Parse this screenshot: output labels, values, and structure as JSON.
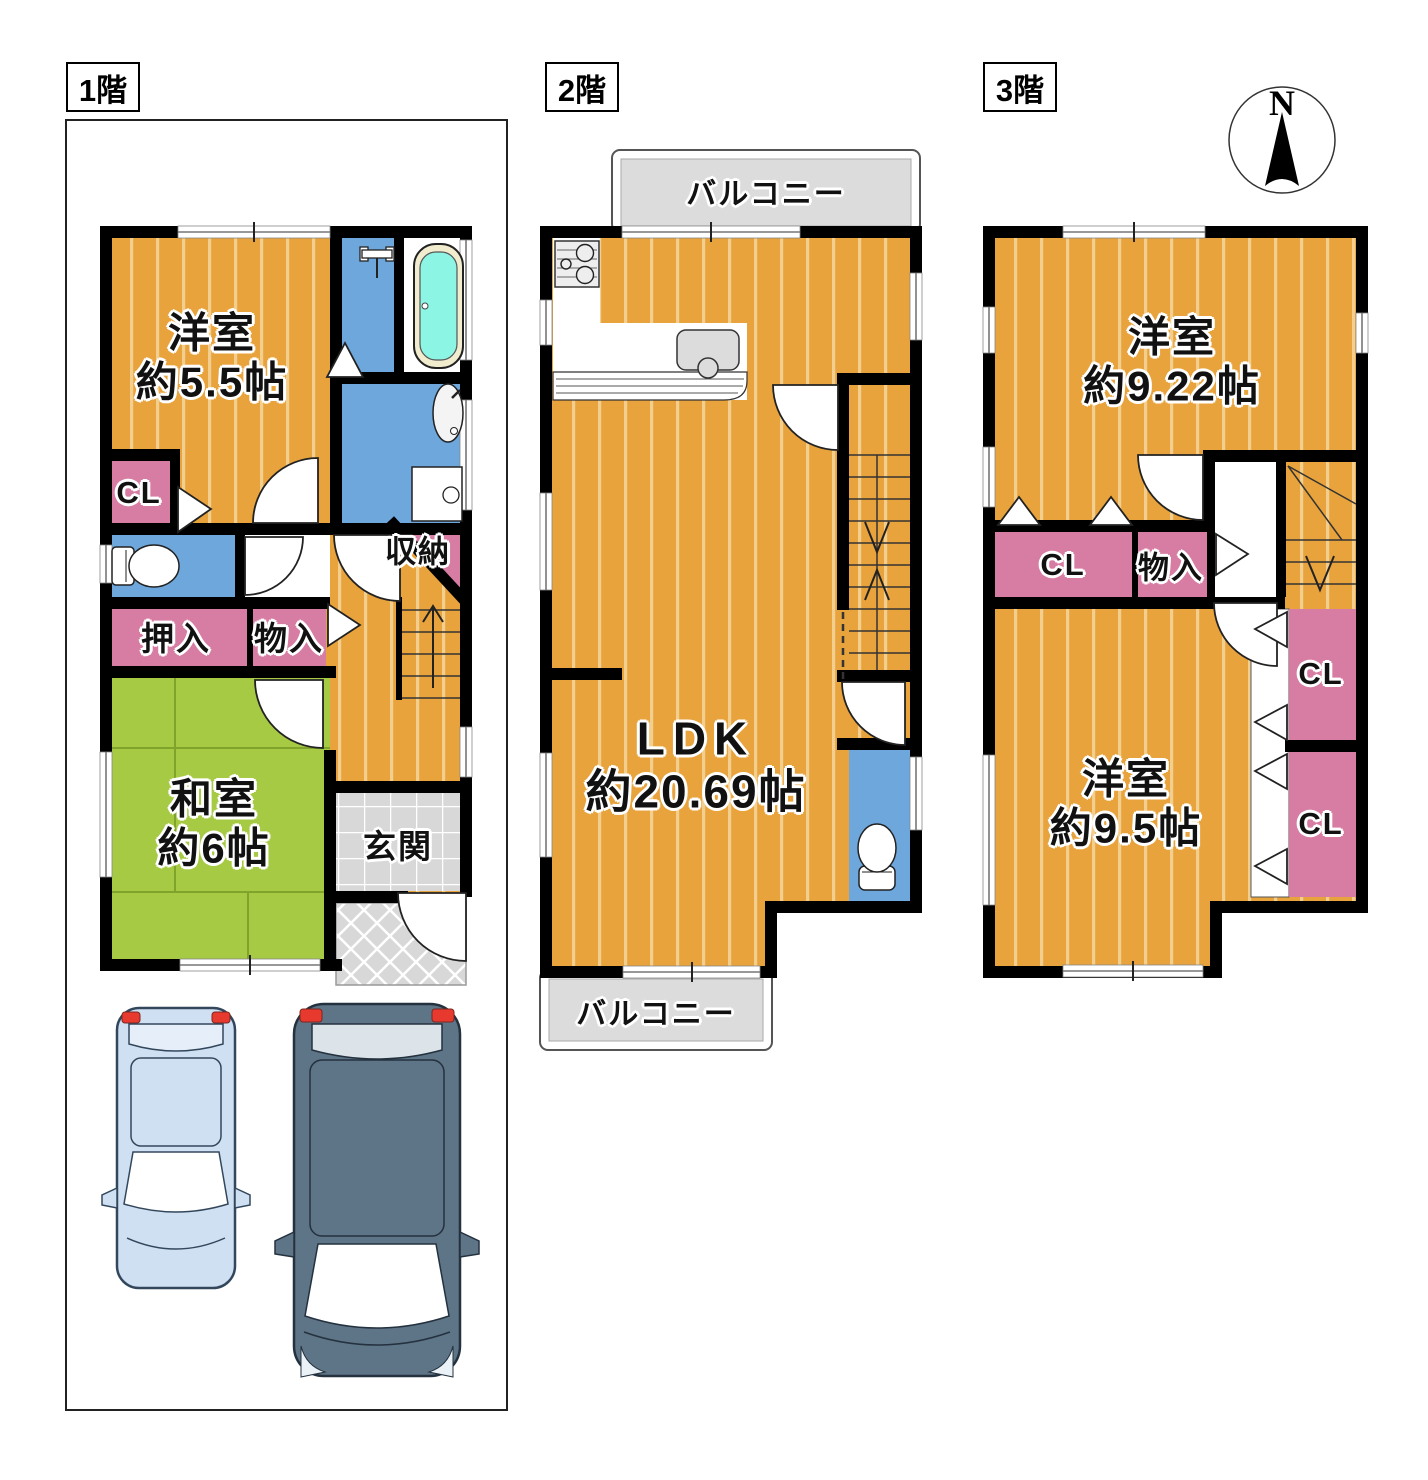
{
  "compass": {
    "north_label": "N"
  },
  "floors": {
    "f1": {
      "label": "1階",
      "western_room": {
        "name": "洋室",
        "size": "約5.5帖"
      },
      "closet_label": "CL",
      "storage_label": "収納",
      "oshiire_label": "押入",
      "monoire_label": "物入",
      "japanese_room": {
        "name": "和室",
        "size": "約6帖"
      },
      "entrance_label": "玄関"
    },
    "f2": {
      "label": "2階",
      "balcony_top_label": "バルコニー",
      "balcony_bottom_label": "バルコニー",
      "ldk": {
        "name": "LDK",
        "size": "約20.69帖"
      }
    },
    "f3": {
      "label": "3階",
      "western_room_a": {
        "name": "洋室",
        "size": "約9.22帖"
      },
      "closet_row_label": "CL",
      "monoire_label": "物入",
      "western_room_b": {
        "name": "洋室",
        "size": "約9.5帖"
      },
      "closet_upper_label": "CL",
      "closet_lower_label": "CL"
    }
  },
  "colors": {
    "floor_orange": "#E8A33C",
    "floor_stripe": "#F3CF8F",
    "tatami_green": "#A6CA44",
    "wet_area_blue": "#6EA7DC",
    "closet_pink": "#D77CA2",
    "bathtub_cyan": "#8CF5E4",
    "balcony_gray": "#DCDCDC",
    "entrance_tile_gray": "#D8D8D8",
    "wall_black": "#000000",
    "car_light_blue": "#CFE0F2",
    "car_dark_slate": "#5E7487"
  }
}
